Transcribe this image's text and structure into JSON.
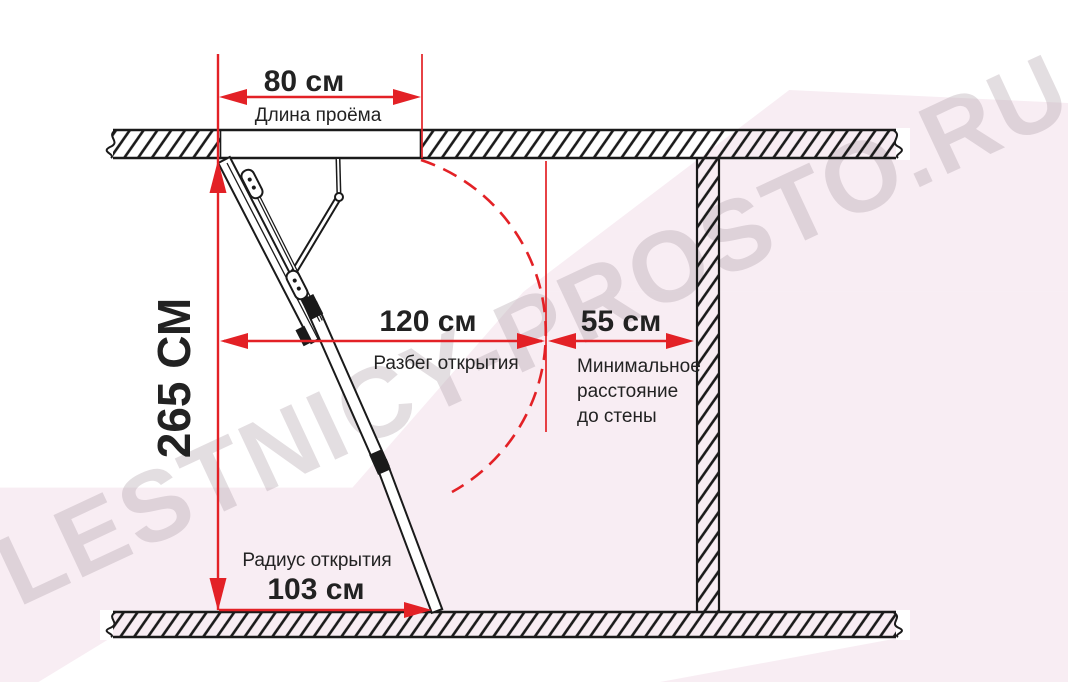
{
  "diagram": {
    "title_context": "attic-ladder-dimensions",
    "watermark": "LESTNICY-PROSTO.RU",
    "dimensions": {
      "opening": {
        "value": "80 см",
        "label": "Длина проёма"
      },
      "height": {
        "value": "265 СМ"
      },
      "run": {
        "value": "120 см",
        "label": "Разбег открытия"
      },
      "wall": {
        "value": "55 см",
        "lines": [
          "Минимальное",
          "расстояние",
          "до стены"
        ]
      },
      "radius": {
        "value": "103 см",
        "label": "Радиус открытия"
      }
    },
    "colors": {
      "red": "#e32126",
      "line": "#1a1a1a",
      "pink": "#f8edf3",
      "watermark_gray": "#a799a1"
    }
  }
}
